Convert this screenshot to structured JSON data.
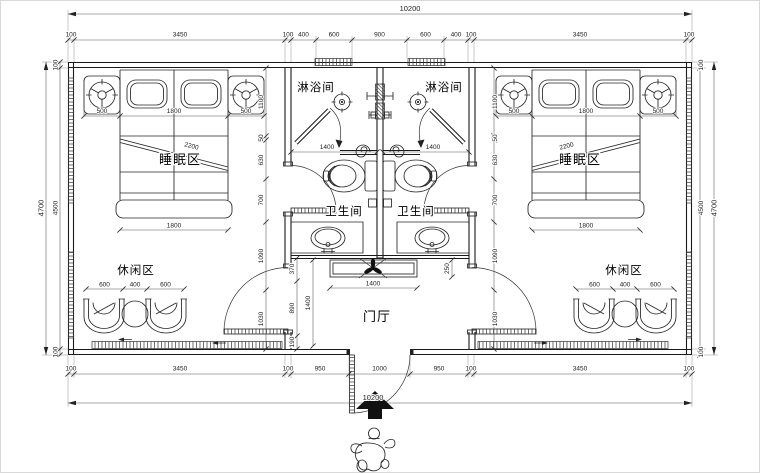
{
  "labels": {
    "shower": "淋浴间",
    "toilet": "卫生间",
    "sleep": "睡眠区",
    "leisure": "休闲区",
    "hall": "门厅"
  },
  "dims": {
    "total": "10200",
    "top_chain": [
      "100",
      "3450",
      "100",
      "400",
      "600",
      "900",
      "600",
      "400",
      "100",
      "3450",
      "100"
    ],
    "bottom_chain": [
      "100",
      "3450",
      "100",
      "950",
      "1000",
      "950",
      "100",
      "3450",
      "100"
    ],
    "side": {
      "outer": "4700",
      "inner": "4500",
      "wall": "100"
    },
    "bed": {
      "side": "500",
      "width": "1800",
      "diag": "2200"
    },
    "room_chain": [
      "1100",
      "50",
      "630",
      "700",
      "1090",
      "1030"
    ],
    "bath_width": "1400",
    "console": {
      "width": "1400",
      "depth": "250"
    },
    "hall_chain": [
      "370",
      "890",
      "190"
    ],
    "hall_depth": "1400",
    "leisure": {
      "chair": "600",
      "table": "400"
    }
  }
}
